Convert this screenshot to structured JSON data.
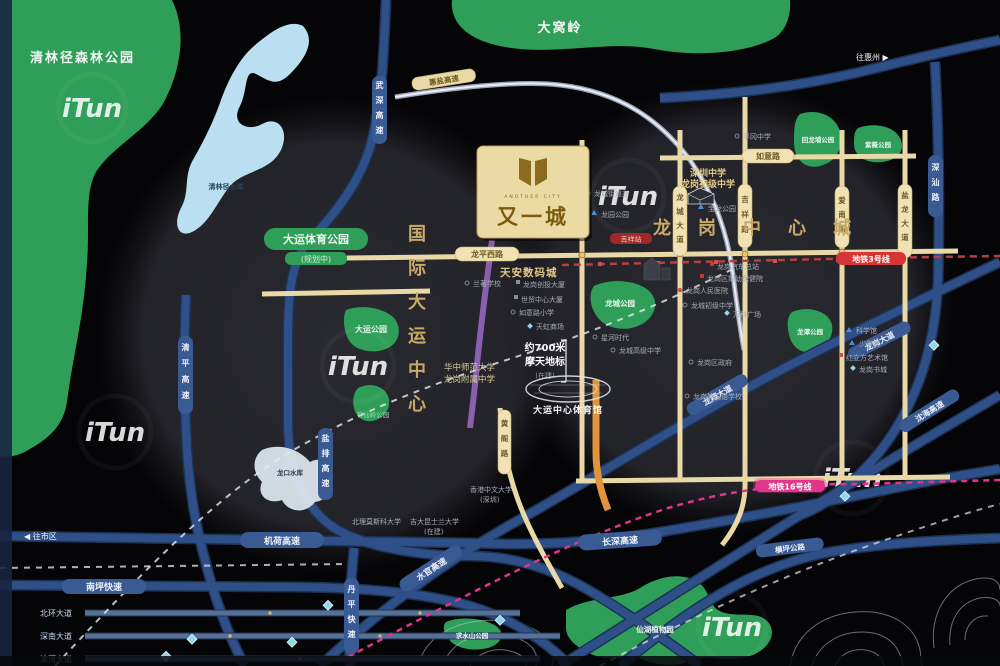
{
  "brand": {
    "name": "又一城",
    "latin": "ANOTHER CITY"
  },
  "districts": {
    "universiade": "国际大运中心",
    "longgang": "龙岗中心城"
  },
  "parks": {
    "qinglinjing": "清林径森林公园",
    "reservoir": "清林径水库",
    "dawoling": "大窝岭",
    "dayun_sports": "大运体育公园",
    "dayun_sports_note": "(规划中)",
    "dayun": "大运公园",
    "shenxianling": "神仙岭公园",
    "longcheng": "龙城公园",
    "huilongpu": "回龙埔公园",
    "ziwei": "紫薇公园",
    "longtan": "龙潭公园",
    "qiushuishan": "求水山公园",
    "xianhu": "仙湖植物园",
    "longkou": "龙口水库",
    "longyuan": "龙园公园",
    "baolong": "宝龙公园"
  },
  "roads": {
    "wushen": "武深高速",
    "qingping": "清平高速",
    "yanpai": "盐排高速",
    "jihe": "机荷高速",
    "nanping": "南坪快速",
    "changshen": "长深高速",
    "shuiguan": "水官高速",
    "danping": "丹平快速",
    "longxiang": "龙翔大道",
    "longgang_ave": "龙岗大道",
    "shenhai": "沈海高速",
    "shenshan": "深汕路",
    "huiyan": "惠盐高速",
    "hengping": "横坪公路",
    "longping_west": "龙平西路",
    "ruyi": "如意路",
    "huangge": "黄阁路",
    "qinglin": "清林路",
    "longcheng_ave": "龙城大道",
    "jixiang": "吉祥路",
    "ainan": "爱南路",
    "yanlong": "盐龙大道",
    "beihuan": "北环大道",
    "shennan": "深南大道",
    "binhe": "滨河大道"
  },
  "metro": {
    "line3": "地铁3号线",
    "jixiang_station": "吉祥站",
    "line16": "地铁16号线"
  },
  "landmark": {
    "dist": "约700米",
    "tower": "摩天地标",
    "status": "(在建)",
    "stadium": "大运中心体育馆"
  },
  "pois": {
    "tianan": "天安数码城",
    "szms": "深圳中学",
    "szms2": "龙岗初级中学",
    "hzsf1": "华中师范大学",
    "hzsf2": "龙岗附属中学",
    "cuhk1": "香港中文大学",
    "cuhk2": "(深圳)",
    "msk": "北理莫斯科大学",
    "jlqd1": "吉大昆士兰大学",
    "jlqd2": "(在建)",
    "street": "龙城街道办",
    "bus": "龙岗汽车总站",
    "fuyou": "龙岗区妇幼保健院",
    "hospital": "龙岗人民医院",
    "lczx": "龙城初级中学",
    "vanke": "万科广场",
    "pinggang": "平冈中学",
    "gov": "龙岗区政府",
    "foreign": "龙岗外国语学校",
    "lanzhu": "兰著学校",
    "chuangtou": "龙岗创投大厦",
    "shimao": "世贸中心大厦",
    "ruyixx": "如意路小学",
    "tianhong": "天虹商场",
    "xinghe": "星河时代",
    "lcgz": "龙城高级中学",
    "science": "科学馆",
    "youth": "少年宫",
    "redcube": "红立方艺术馆",
    "bookcity": "龙岗书城"
  },
  "directions": {
    "to_city": "◀ 往市区",
    "to_huizhou": "往惠州 ▶"
  },
  "watermark": "iTun",
  "colors": {
    "park": "#2f9e58",
    "water": "#b9dff0",
    "road_blue": "#2e4f87",
    "road_beige": "#e9d9a6",
    "gold": "#c8a968",
    "metro_red": "#c0392b",
    "metro_pink": "#e0358b",
    "brand_bg": "#ecdaa4",
    "brand_fg": "#7a5c10"
  }
}
